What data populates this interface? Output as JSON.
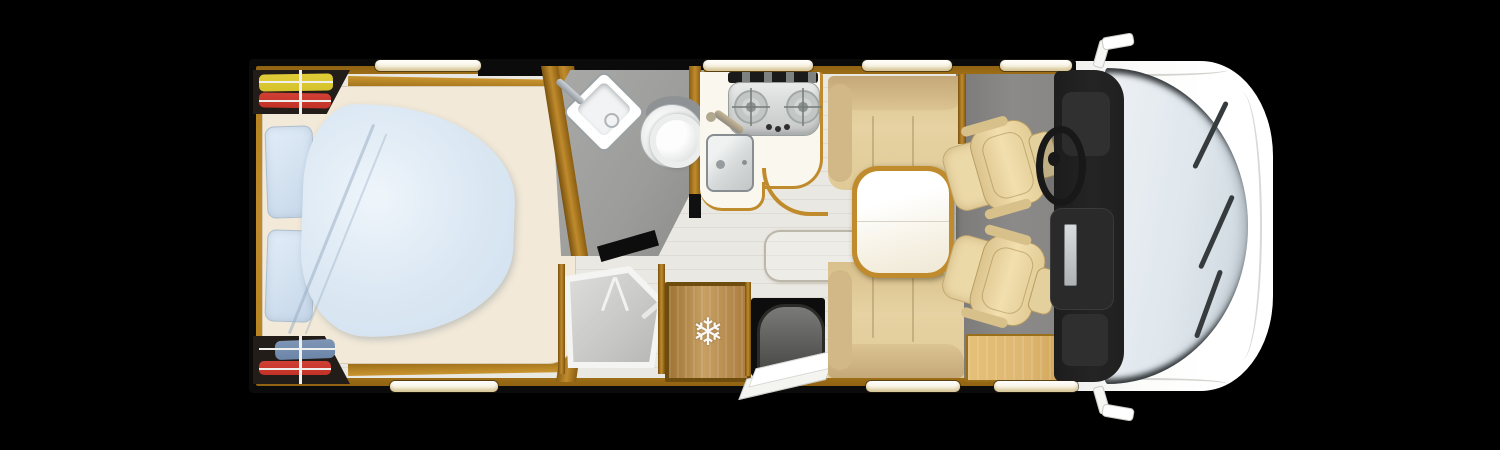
{
  "scene": {
    "type": "motorhome-floorplan-top-view",
    "background": "#000000"
  },
  "palette": {
    "bg": "#000000",
    "wall": "#0b0b0b",
    "wood": "#b5831f",
    "wood_light": "#c08b2d",
    "floor": "#eae8e2",
    "bath_floor": "#9c9c9a",
    "cab_floor": "#8b8a88",
    "counter": "#faf7ef",
    "mattress": "#f2e9d8",
    "duvet": "#cfdfee",
    "pillow": "#c6d7e9",
    "bench": "#e6d2a2",
    "seat": "#ecd9a8",
    "side_cabinet": "#ddb671",
    "dashboard": "#242424",
    "glass": "#dfe7ed",
    "body": "#ffffff",
    "shower_tray": "#c9c9c7",
    "appliance": "#d4d6d5",
    "garment_yellow": "#d6c22b",
    "garment_red": "#c23227",
    "garment_blue": "#6c86a8",
    "window_strip": "#ffffff",
    "door": "#f8f8f6"
  },
  "icons": {
    "fridge_snowflake": "❄"
  },
  "windows": {
    "top_count": 4,
    "bottom_count": 3
  },
  "regions": [
    {
      "name": "rear-wardrobe-top",
      "contents": [
        "yellow-garment",
        "red-garment",
        "hanger-rails"
      ]
    },
    {
      "name": "rear-wardrobe-bottom",
      "contents": [
        "blue-garment",
        "red-garment",
        "hanger-rails"
      ]
    },
    {
      "name": "rear-bedroom",
      "furniture": [
        "island-bed",
        "two-pillows",
        "rounded-duvet",
        "wood-surround"
      ]
    },
    {
      "name": "bathroom",
      "fixtures": [
        "corner-washbasin",
        "faucet",
        "toilet"
      ]
    },
    {
      "name": "shower",
      "fixtures": [
        "pentagonal-tray",
        "door-handles",
        "faucet"
      ]
    },
    {
      "name": "kitchen",
      "fixtures": [
        "two-burner-cooktop",
        "three-knobs",
        "sink",
        "faucet",
        "curved-counter"
      ]
    },
    {
      "name": "fridge",
      "icon": "fridge_snowflake"
    },
    {
      "name": "entry",
      "fixtures": [
        "entry-step",
        "open-entry-door"
      ]
    },
    {
      "name": "dinette",
      "furniture": [
        "bench-seat-top",
        "bench-seat-bottom",
        "table",
        "side-cabinet",
        "floor-hatch"
      ]
    },
    {
      "name": "cab",
      "furniture": [
        "driver-seat",
        "passenger-seat",
        "steering-wheel",
        "dashboard",
        "windshield",
        "wipers",
        "wing-mirrors"
      ]
    }
  ]
}
